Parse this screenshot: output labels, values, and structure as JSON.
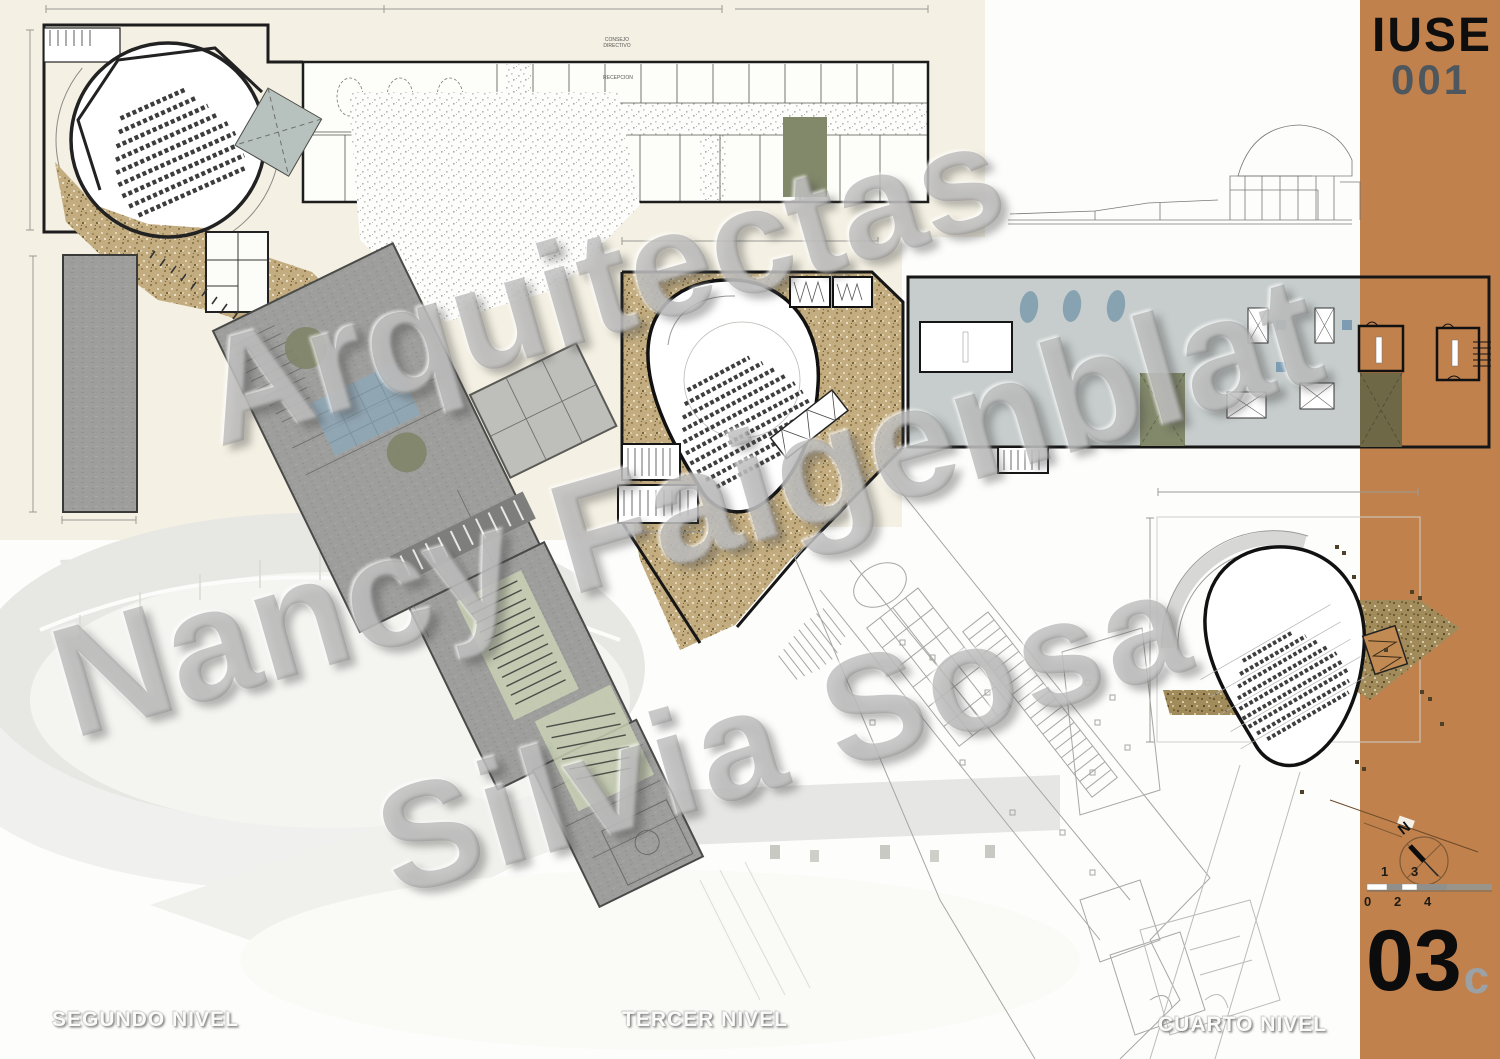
{
  "sheet": {
    "series_code": "IUSE",
    "series_number": "001",
    "sheet_number": "03",
    "sheet_suffix": "c",
    "north_label": "N",
    "scale_top": [
      "1",
      "3"
    ],
    "scale_bottom": [
      "0",
      "2",
      "4"
    ]
  },
  "watermark": {
    "line1": "Arquitectas",
    "line2": "Nancy Faigenblat",
    "line3": "Silvia Sosa"
  },
  "plan_labels": {
    "segundo": "SEGUNDO NIVEL",
    "tercer": "TERCER NIVEL",
    "cuarto": "CUARTO NIVEL"
  },
  "room_labels": {
    "consejo": "CONSEJO\nDIRECTIVO",
    "recepcion": "RECEPCION"
  },
  "colors": {
    "sidebar_orange": "#c1814d",
    "sheet_cream": "#f4f0e3",
    "wall_black": "#1d1d1d",
    "carpet_tan": "#c3ad80",
    "roof_sage": "#82886a",
    "terrace_gray": "#c6cdcc",
    "skylight_blue": "#87a2b0",
    "plaza_gray": "#9e9e9c",
    "stair_green": "#ccd4b6",
    "watermark_gray": "#808080",
    "number_gray": "#4e575d",
    "suffix_gray": "#9ba1a5"
  }
}
